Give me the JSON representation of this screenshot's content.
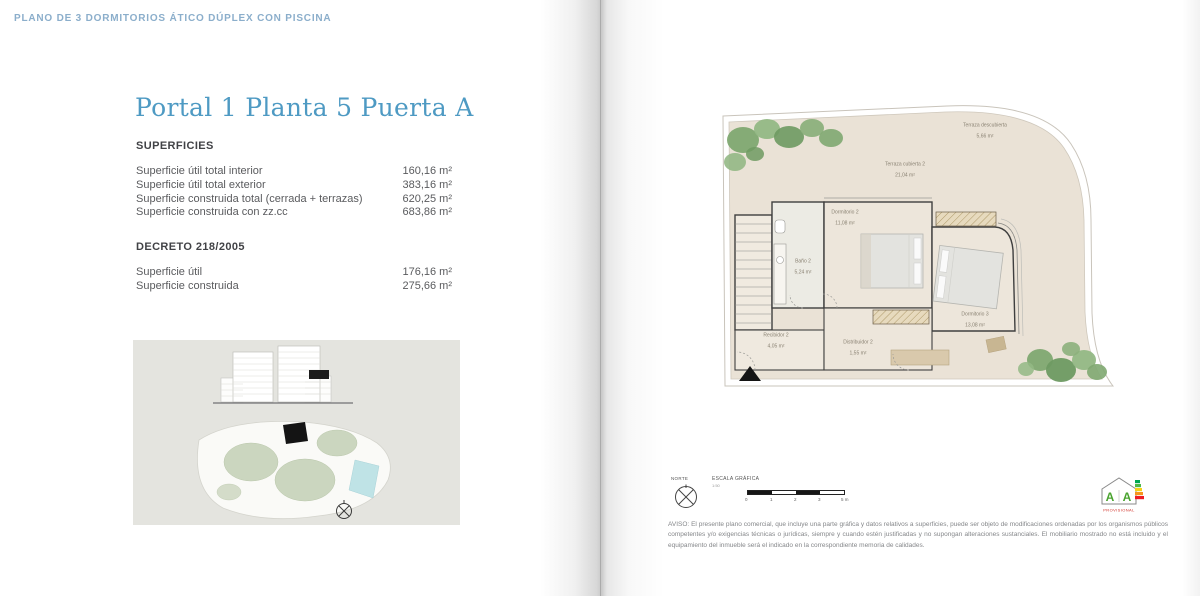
{
  "doc_header": {
    "label": "PLANO DE 3 DORMITORIOS ÁTICO DÚPLEX CON PISCINA"
  },
  "left_page": {
    "title": "Portal 1 Planta 5 Puerta A",
    "superficies": {
      "heading": "SUPERFICIES",
      "rows": [
        {
          "label": "Superficie útil total interior",
          "value": "160,16 m²"
        },
        {
          "label": "Superficie útil total exterior",
          "value": "383,16 m²"
        },
        {
          "label": "Superficie construida total (cerrada + terrazas)",
          "value": "620,25 m²"
        },
        {
          "label": "Superficie construida con zz.cc",
          "value": "683,86 m²"
        }
      ]
    },
    "decreto": {
      "heading": "DECRETO 218/2005",
      "rows": [
        {
          "label": "Superficie útil",
          "value": "176,16 m²"
        },
        {
          "label": "Superficie construida",
          "value": "275,66 m²"
        }
      ]
    }
  },
  "right_page": {
    "rooms": [
      {
        "name": "Terraza descubierta",
        "area": "5,66 m²"
      },
      {
        "name": "Terraza cubierta 2",
        "area": "21,04 m²"
      },
      {
        "name": "Dormitorio 2",
        "area": "11,08 m²"
      },
      {
        "name": "Baño 2",
        "area": "5,24 m²"
      },
      {
        "name": "Dormitorio 3",
        "area": "13,08 m²"
      },
      {
        "name": "Recibidor 2",
        "area": "4,05 m²"
      },
      {
        "name": "Distribuidor 2",
        "area": "1,55 m²"
      }
    ],
    "footer": {
      "norte_label": "NORTE",
      "escala_label": "ESCALA GRÁFICA",
      "escala_ratio": "1:50",
      "scale_ticks": [
        "0",
        "1",
        "2",
        "3",
        "5 m"
      ],
      "energy_letter_1": "A",
      "energy_letter_2": "A",
      "energy_status": "PROVISIONAL"
    },
    "disclaimer": "AVISO: El presente plano comercial, que incluye una parte gráfica y datos relativos a superficies, puede ser objeto de modificaciones ordenadas por los organismos públicos competentes y/o exigencias técnicas o jurídicas, siempre y cuando estén justificadas y no supongan alteraciones sustanciales. El mobiliario mostrado no está incluido y el equipamiento del inmueble será el indicado en la correspondiente memoria de calidades."
  },
  "colors": {
    "header_blue": "#8BAECB",
    "title_blue": "#4E9AC3",
    "text_gray": "#58595B",
    "plan_beige": "#EAE2D6"
  }
}
